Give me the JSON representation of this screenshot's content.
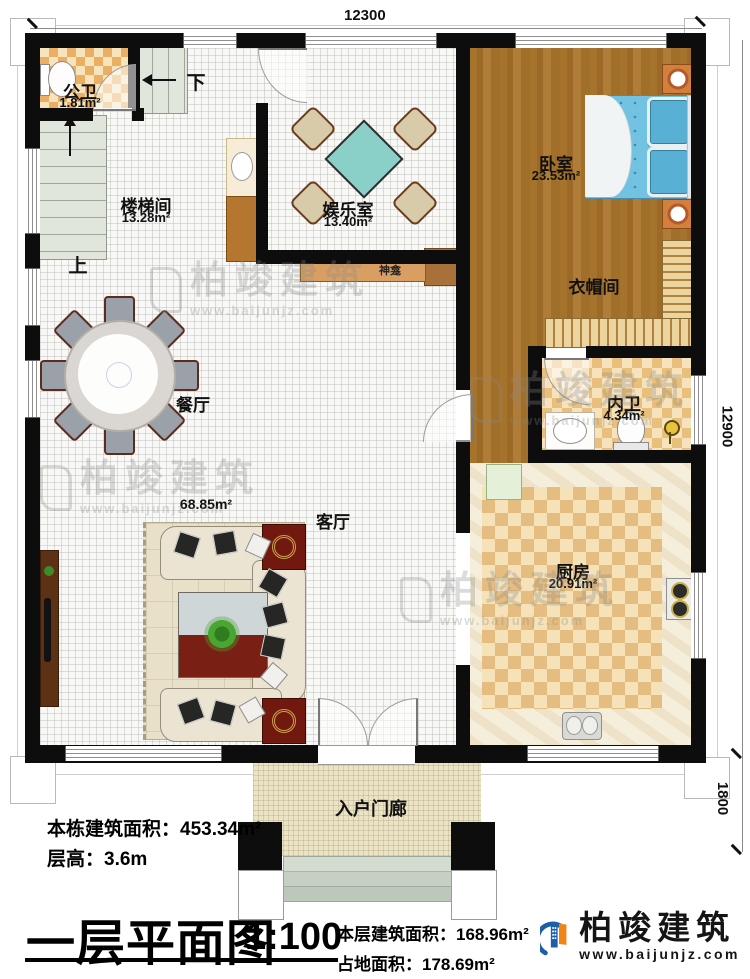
{
  "dimensions": {
    "top": "12300",
    "right": "12900",
    "porch": "1800"
  },
  "stairs": {
    "up": "上",
    "down": "下"
  },
  "rooms": {
    "public_bath": {
      "name": "公卫",
      "area": "1.81m²"
    },
    "stairwell": {
      "name": "楼梯间",
      "area": "13.28m²"
    },
    "recreation": {
      "name": "娱乐室",
      "area": "13.40m²"
    },
    "bedroom": {
      "name": "卧室",
      "area": "23.53m²"
    },
    "cloakroom": {
      "name": "衣帽间"
    },
    "ensuite_bath": {
      "name": "内卫",
      "area": "4.34m²"
    },
    "dining": {
      "name": "餐厅"
    },
    "living": {
      "name": "客厅",
      "area": "68.85m²"
    },
    "kitchen": {
      "name": "厨房",
      "area": "20.91m²"
    },
    "porch": {
      "name": "入户门廊"
    },
    "shrine": {
      "name": "神龛"
    }
  },
  "footer": {
    "total_building_area": "本栋建筑面积：453.34m²",
    "floor_height": "层高：3.6m",
    "plan_title": "一层平面图",
    "scale": "1:100",
    "floor_area": "本层建筑面积：168.96m²",
    "land_area": "占地面积：178.69m²"
  },
  "logo": {
    "company": "柏竣建筑",
    "website": "www.baijunjz.com"
  },
  "watermark": {
    "brand": "柏竣建筑",
    "site": "www.baijunjz.com"
  }
}
